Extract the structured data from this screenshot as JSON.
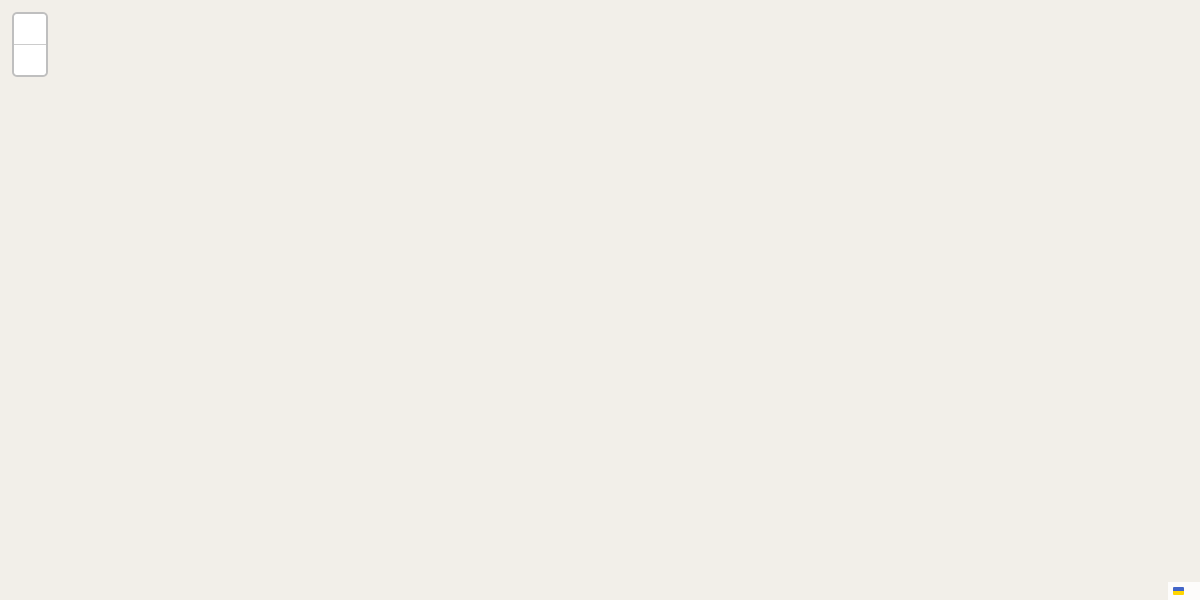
{
  "controls": {
    "zoom_in": "+",
    "zoom_out": "−"
  },
  "attribution": {
    "leaflet": "Leaflet",
    "sep": "|",
    "osm": "© OpenStreetMap"
  },
  "badge": {
    "text": "ER 258"
  },
  "colors": {
    "overlay_blue_stroke": "#2e6da4",
    "overlay_blue_fill": "rgba(115,140,165,0.20)",
    "overlay_red_stroke": "#9c3244",
    "overlay_red_fill": "rgba(228,110,110,0.50)",
    "road_yellow": "#f1e657",
    "water": "#a6cfdf",
    "stream": "#b8c4e4",
    "green_area": "#cfe8ca",
    "park_mint": "#dcf0de",
    "school_yellow": "#f6f2d5",
    "vineyard_green": "#b5dba2",
    "poi_orange": "#bd7300",
    "poi_purple": "#a839a8",
    "poi_blue": "#1b6ab2",
    "poi_red": "#cc3333",
    "poi_green": "#49921e",
    "poi_olive": "#9b8b1e",
    "poi_brown": "#7a5437",
    "poi_grey": "#555555",
    "terminal_blue": "#2563c4",
    "icon_brown": "#8a5a28"
  },
  "streets": [
    {
      "t": "Rua do Poço da Figueira",
      "x": 333,
      "y": 80,
      "r": -23
    },
    {
      "t": "Rua Nova do Poço da Figueira",
      "x": 196,
      "y": 149,
      "r": 24
    },
    {
      "t": "Estrada de Cuba",
      "x": 441,
      "y": 163,
      "r": -48
    },
    {
      "t": "Rua das Olarias",
      "x": 669,
      "y": 189,
      "r": 36
    },
    {
      "t": "Rua da Guarda",
      "x": 806,
      "y": 99,
      "r": 57
    },
    {
      "t": "Travessa das Olarias",
      "x": 550,
      "y": 313,
      "r": -59
    },
    {
      "t": "Rua de São João",
      "x": 618,
      "y": 313,
      "r": 31
    },
    {
      "t": "Rua Aquiles Estaco",
      "x": 491,
      "y": 372,
      "r": 33
    },
    {
      "t": "Rua dos Casões do Sindicato",
      "x": 792,
      "y": 387,
      "r": -40
    },
    {
      "t": "Rua dos Escudeiros",
      "x": 1128,
      "y": 237,
      "r": 14
    },
    {
      "t": "Rua da Hortinha",
      "x": 1032,
      "y": 305,
      "r": 74
    },
    {
      "t": "Travessa das Fragosas",
      "x": 1126,
      "y": 320,
      "r": 21
    }
  ],
  "curved_streets": [
    {
      "id": "fialho",
      "t": "Rua Doutor José Valentim Fialho de Almeida"
    },
    {
      "id": "bairro",
      "t": "Bairro Doutor António Covas Lima"
    },
    {
      "id": "estci",
      "t": "Estrada da Ci"
    }
  ],
  "numbers": [
    [
      106,
      92,
      "22"
    ],
    [
      129,
      97,
      "20"
    ],
    [
      222,
      118,
      "30"
    ],
    [
      237,
      112,
      "28"
    ],
    [
      268,
      95,
      "22"
    ],
    [
      246,
      139,
      "21"
    ],
    [
      272,
      126,
      "19"
    ],
    [
      286,
      119,
      "17"
    ],
    [
      296,
      84,
      "18"
    ],
    [
      311,
      73,
      "16"
    ],
    [
      360,
      51,
      "8"
    ],
    [
      388,
      33,
      "4"
    ],
    [
      379,
      40,
      "6"
    ],
    [
      298,
      173,
      "10"
    ],
    [
      318,
      181,
      "8"
    ],
    [
      418,
      153,
      "16"
    ],
    [
      399,
      166,
      "18"
    ],
    [
      560,
      42,
      "77"
    ],
    [
      537,
      63,
      "2"
    ],
    [
      526,
      71,
      "4"
    ],
    [
      510,
      81,
      "6"
    ],
    [
      484,
      103,
      "8"
    ],
    [
      472,
      113,
      "10"
    ],
    [
      557,
      98,
      "1"
    ],
    [
      595,
      93,
      "48"
    ],
    [
      492,
      144,
      "11"
    ],
    [
      467,
      170,
      "15"
    ],
    [
      690,
      6,
      "68"
    ],
    [
      667,
      22,
      "69"
    ],
    [
      613,
      51,
      "74"
    ],
    [
      778,
      15,
      "45"
    ],
    [
      807,
      23,
      "43"
    ],
    [
      828,
      32,
      "39"
    ],
    [
      853,
      38,
      "35"
    ],
    [
      743,
      43,
      "26"
    ],
    [
      765,
      60,
      "24"
    ],
    [
      785,
      79,
      "22"
    ],
    [
      745,
      78,
      "39"
    ],
    [
      867,
      5,
      "24"
    ],
    [
      853,
      143,
      "10"
    ],
    [
      862,
      154,
      "8"
    ],
    [
      833,
      156,
      "19"
    ],
    [
      607,
      150,
      "35"
    ],
    [
      636,
      144,
      "38"
    ],
    [
      658,
      164,
      "32"
    ],
    [
      623,
      168,
      "31"
    ],
    [
      889,
      48,
      "31"
    ],
    [
      975,
      71,
      "23"
    ],
    [
      1004,
      73,
      "30"
    ],
    [
      995,
      98,
      "28"
    ],
    [
      972,
      118,
      "39"
    ],
    [
      966,
      143,
      "37"
    ],
    [
      993,
      135,
      "26"
    ],
    [
      954,
      164,
      "29"
    ],
    [
      1099,
      57,
      "16"
    ],
    [
      1117,
      59,
      "14"
    ],
    [
      1136,
      56,
      "12"
    ],
    [
      1153,
      52,
      "10"
    ],
    [
      1168,
      52,
      "8"
    ],
    [
      1185,
      43,
      "6A"
    ],
    [
      1111,
      80,
      "17"
    ],
    [
      877,
      166,
      "6"
    ],
    [
      378,
      245,
      "25A"
    ],
    [
      365,
      256,
      "27"
    ],
    [
      352,
      267,
      "29"
    ],
    [
      350,
      359,
      "26"
    ],
    [
      385,
      373,
      "24"
    ],
    [
      343,
      189,
      "2"
    ],
    [
      405,
      215,
      "21"
    ],
    [
      418,
      214,
      "19"
    ],
    [
      493,
      230,
      "34"
    ],
    [
      469,
      243,
      "33"
    ],
    [
      509,
      262,
      "27"
    ],
    [
      544,
      258,
      "28"
    ],
    [
      563,
      267,
      "26"
    ],
    [
      541,
      282,
      "25"
    ],
    [
      611,
      285,
      "24"
    ],
    [
      636,
      298,
      "20"
    ],
    [
      657,
      309,
      "18"
    ],
    [
      683,
      323,
      "12"
    ],
    [
      707,
      339,
      "8"
    ],
    [
      733,
      354,
      "6"
    ],
    [
      765,
      372,
      "2"
    ],
    [
      672,
      352,
      "11"
    ],
    [
      692,
      363,
      "7"
    ],
    [
      718,
      378,
      "3"
    ],
    [
      738,
      388,
      "1"
    ],
    [
      411,
      306,
      "32"
    ],
    [
      432,
      321,
      "28"
    ],
    [
      453,
      328,
      "24"
    ],
    [
      413,
      389,
      "22"
    ],
    [
      545,
      390,
      "14"
    ],
    [
      574,
      402,
      "12"
    ],
    [
      595,
      414,
      "10"
    ],
    [
      705,
      192,
      "28"
    ],
    [
      727,
      207,
      "24"
    ],
    [
      759,
      228,
      "18"
    ],
    [
      774,
      240,
      "14"
    ],
    [
      727,
      240,
      "19"
    ],
    [
      763,
      260,
      "13"
    ],
    [
      777,
      273,
      "13A"
    ],
    [
      806,
      259,
      "8"
    ],
    [
      827,
      274,
      "6"
    ],
    [
      796,
      285,
      "9"
    ],
    [
      808,
      292,
      "7"
    ],
    [
      819,
      302,
      "5"
    ],
    [
      833,
      309,
      "3"
    ],
    [
      846,
      317,
      "1"
    ],
    [
      847,
      287,
      "4"
    ],
    [
      857,
      291,
      "2"
    ],
    [
      849,
      180,
      "15"
    ],
    [
      891,
      183,
      "4"
    ],
    [
      879,
      207,
      "9"
    ],
    [
      908,
      201,
      "5"
    ],
    [
      899,
      212,
      "7"
    ],
    [
      933,
      179,
      "25"
    ],
    [
      950,
      192,
      "23"
    ],
    [
      907,
      277,
      "6"
    ],
    [
      947,
      282,
      "1A"
    ],
    [
      912,
      307,
      "3"
    ],
    [
      877,
      341,
      "7"
    ],
    [
      719,
      380,
      "3"
    ],
    [
      739,
      391,
      "1"
    ],
    [
      728,
      442,
      "23"
    ],
    [
      616,
      425,
      "6"
    ],
    [
      637,
      439,
      "4"
    ],
    [
      659,
      453,
      "2"
    ],
    [
      708,
      457,
      "25"
    ],
    [
      683,
      473,
      "29"
    ],
    [
      663,
      486,
      "31"
    ],
    [
      639,
      477,
      "20"
    ],
    [
      643,
      503,
      "35"
    ],
    [
      623,
      517,
      "37"
    ],
    [
      566,
      473,
      "10"
    ],
    [
      577,
      477,
      "8"
    ],
    [
      590,
      487,
      "6"
    ],
    [
      387,
      375,
      "24"
    ],
    [
      444,
      403,
      "20"
    ],
    [
      540,
      408,
      "5"
    ],
    [
      559,
      420,
      "3"
    ],
    [
      442,
      454,
      "15"
    ],
    [
      454,
      459,
      "13"
    ],
    [
      495,
      477,
      "9"
    ],
    [
      508,
      483,
      "7"
    ],
    [
      524,
      488,
      "5"
    ],
    [
      537,
      496,
      "3"
    ],
    [
      554,
      506,
      "1"
    ],
    [
      985,
      185,
      "44"
    ],
    [
      1010,
      192,
      "40"
    ],
    [
      1039,
      197,
      "36"
    ],
    [
      1066,
      206,
      "32"
    ],
    [
      1086,
      212,
      "30"
    ],
    [
      1122,
      223,
      "24"
    ],
    [
      993,
      213,
      "39"
    ],
    [
      1023,
      221,
      "35"
    ],
    [
      1060,
      230,
      "31"
    ],
    [
      968,
      240,
      "17"
    ],
    [
      992,
      264,
      "15"
    ],
    [
      1048,
      298,
      "16"
    ],
    [
      1076,
      341,
      "12"
    ],
    [
      1103,
      388,
      "8"
    ],
    [
      1178,
      452,
      "16"
    ],
    [
      1166,
      475,
      "20"
    ],
    [
      1162,
      522,
      "6"
    ],
    [
      1152,
      539,
      "12"
    ],
    [
      1147,
      550,
      "14"
    ],
    [
      1136,
      567,
      "18"
    ],
    [
      1125,
      582,
      "20"
    ]
  ],
  "lots": [
    [
      161,
      177,
      "LT 4"
    ],
    [
      205,
      196,
      "LT 3"
    ],
    [
      247,
      213,
      "LT 2"
    ],
    [
      284,
      228,
      "LT 1"
    ],
    [
      133,
      238,
      "LT 7"
    ],
    [
      175,
      255,
      "LT 6"
    ],
    [
      213,
      269,
      "LT 5"
    ],
    [
      672,
      581,
      "LT 1"
    ]
  ],
  "fragments": [
    [
      1,
      505,
      "lexo"
    ],
    [
      1,
      523,
      "cinas"
    ],
    [
      1,
      540,
      "ipais"
    ],
    [
      1,
      558,
      "os"
    ],
    [
      1,
      576,
      "es"
    ]
  ],
  "pois": [
    {
      "id": "residencia-santa-clara",
      "lines": [
        "Residência",
        "Santa Clara"
      ],
      "x": 425,
      "y": 30,
      "c": "#1b6ab2",
      "icon": "hotel",
      "ix": 424,
      "iy": 10,
      "ic": "#1b6ab2"
    },
    {
      "id": "tulipa",
      "lines": [
        "Tulipa"
      ],
      "x": 647,
      "y": 12,
      "c": "#a839a8"
    },
    {
      "id": "costa",
      "lines": [
        "Costa"
      ],
      "x": 777,
      "y": 10,
      "c": "#cc3333"
    },
    {
      "id": "santa-rita",
      "lines": [
        "Santa Rita"
      ],
      "x": 648,
      "y": 53,
      "c": "#bd7300",
      "icon": "cup",
      "ix": 647,
      "iy": 36,
      "ic": "#8a5a28"
    },
    {
      "id": "adega-do-mestre-aires",
      "lines": [
        "Adega",
        "do Mestre",
        "Aires"
      ],
      "x": 708,
      "y": 65,
      "c": "#bd7300",
      "icon": "glass",
      "ix": 707,
      "iy": 46,
      "ic": "#bd7300"
    },
    {
      "id": "pe-de-cafe",
      "lines": [
        "Pé de Café"
      ],
      "x": 608,
      "y": 129,
      "c": "#bd7300",
      "icon": "cup",
      "ix": 607,
      "iy": 112,
      "ic": "#8a5a28"
    },
    {
      "id": "lucio-e-fialho",
      "lines": [
        "Lúcio &",
        "Fialho"
      ],
      "x": 533,
      "y": 139,
      "c": "#a839a8",
      "icon": "factory",
      "ix": 533,
      "iy": 121,
      "ic": "#a839a8"
    },
    {
      "id": "supermarket",
      "lines": [],
      "x": 585,
      "y": 76,
      "c": "#a839a8",
      "icon": "cart",
      "ix": 585,
      "iy": 76,
      "ic": "#a839a8"
    },
    {
      "id": "restaurant",
      "lines": [],
      "x": 452,
      "y": 130,
      "c": "#c07b00",
      "icon": "restaurant",
      "ix": 452,
      "iy": 130,
      "ic": "#c07b00"
    },
    {
      "id": "stop",
      "lines": [
        "Stop"
      ],
      "x": 370,
      "y": 218,
      "c": "#bd7300",
      "icon": "cup",
      "ix": 369,
      "iy": 202,
      "ic": "#8a5a28"
    },
    {
      "id": "snack-bar-31",
      "lines": [
        "Snack",
        "Bar 31"
      ],
      "x": 325,
      "y": 309,
      "c": "#bd7300",
      "icon": "cup",
      "ix": 326,
      "iy": 292,
      "ic": "#8a5a28"
    },
    {
      "id": "o-rafa-bbq",
      "lines": [
        "O Rafa",
        "BBQ"
      ],
      "x": 317,
      "y": 364,
      "c": "#bd7300",
      "icon": "restaurant",
      "ix": 317,
      "iy": 348,
      "ic": "#c07b00"
    },
    {
      "id": "posto-territorial",
      "lines": [
        "Posto Territorial",
        "de Vidigueira"
      ],
      "x": 915,
      "y": 75,
      "c": "#9b8b1e",
      "icon": "shield",
      "ix": 915,
      "iy": 60,
      "ic": "#9b8b1e"
    },
    {
      "id": "torre-do-relogio",
      "lines": [
        "Torre do",
        "Relógio"
      ],
      "x": 1136,
      "y": 103,
      "c": "#555555",
      "icon": "tower",
      "ix": 1136,
      "iy": 87,
      "ic": "#555555"
    },
    {
      "id": "agricola",
      "lines": [
        "Agrícola"
      ],
      "x": 947,
      "y": 6,
      "c": "#49921e"
    },
    {
      "id": "posto-de-turismo",
      "lines": [
        "Posto de",
        "Turismo",
        "de Vidigueira"
      ],
      "x": 123,
      "y": 432,
      "c": "#7a5437",
      "icon": "info",
      "ix": 123,
      "iy": 414,
      "ic": "#7a4030"
    },
    {
      "id": "vidigueira-terminal",
      "lines": [
        "Vidigueira",
        "Terminal"
      ],
      "x": 339,
      "y": 457,
      "c": "#2563c4",
      "icon": "bus",
      "ix": 339,
      "iy": 441,
      "ic": "#2563c4"
    },
    {
      "id": "escola-profissional",
      "lines": [
        "Escola",
        "Profissional",
        "Fialho",
        "de Almeida",
        "(Sede)"
      ],
      "x": 257,
      "y": 503,
      "c": "#4f4f4f"
    },
    {
      "id": "quartos-sao-rafael",
      "lines": [
        "Quartos",
        "São Rafael"
      ],
      "x": 1118,
      "y": 423,
      "c": "#1b6ab2",
      "icon": "hotel",
      "ix": 1117,
      "iy": 407,
      "ic": "#1b6ab2"
    }
  ],
  "oneway_arrow": {
    "x": 1052,
    "y": 219,
    "r": 12
  }
}
